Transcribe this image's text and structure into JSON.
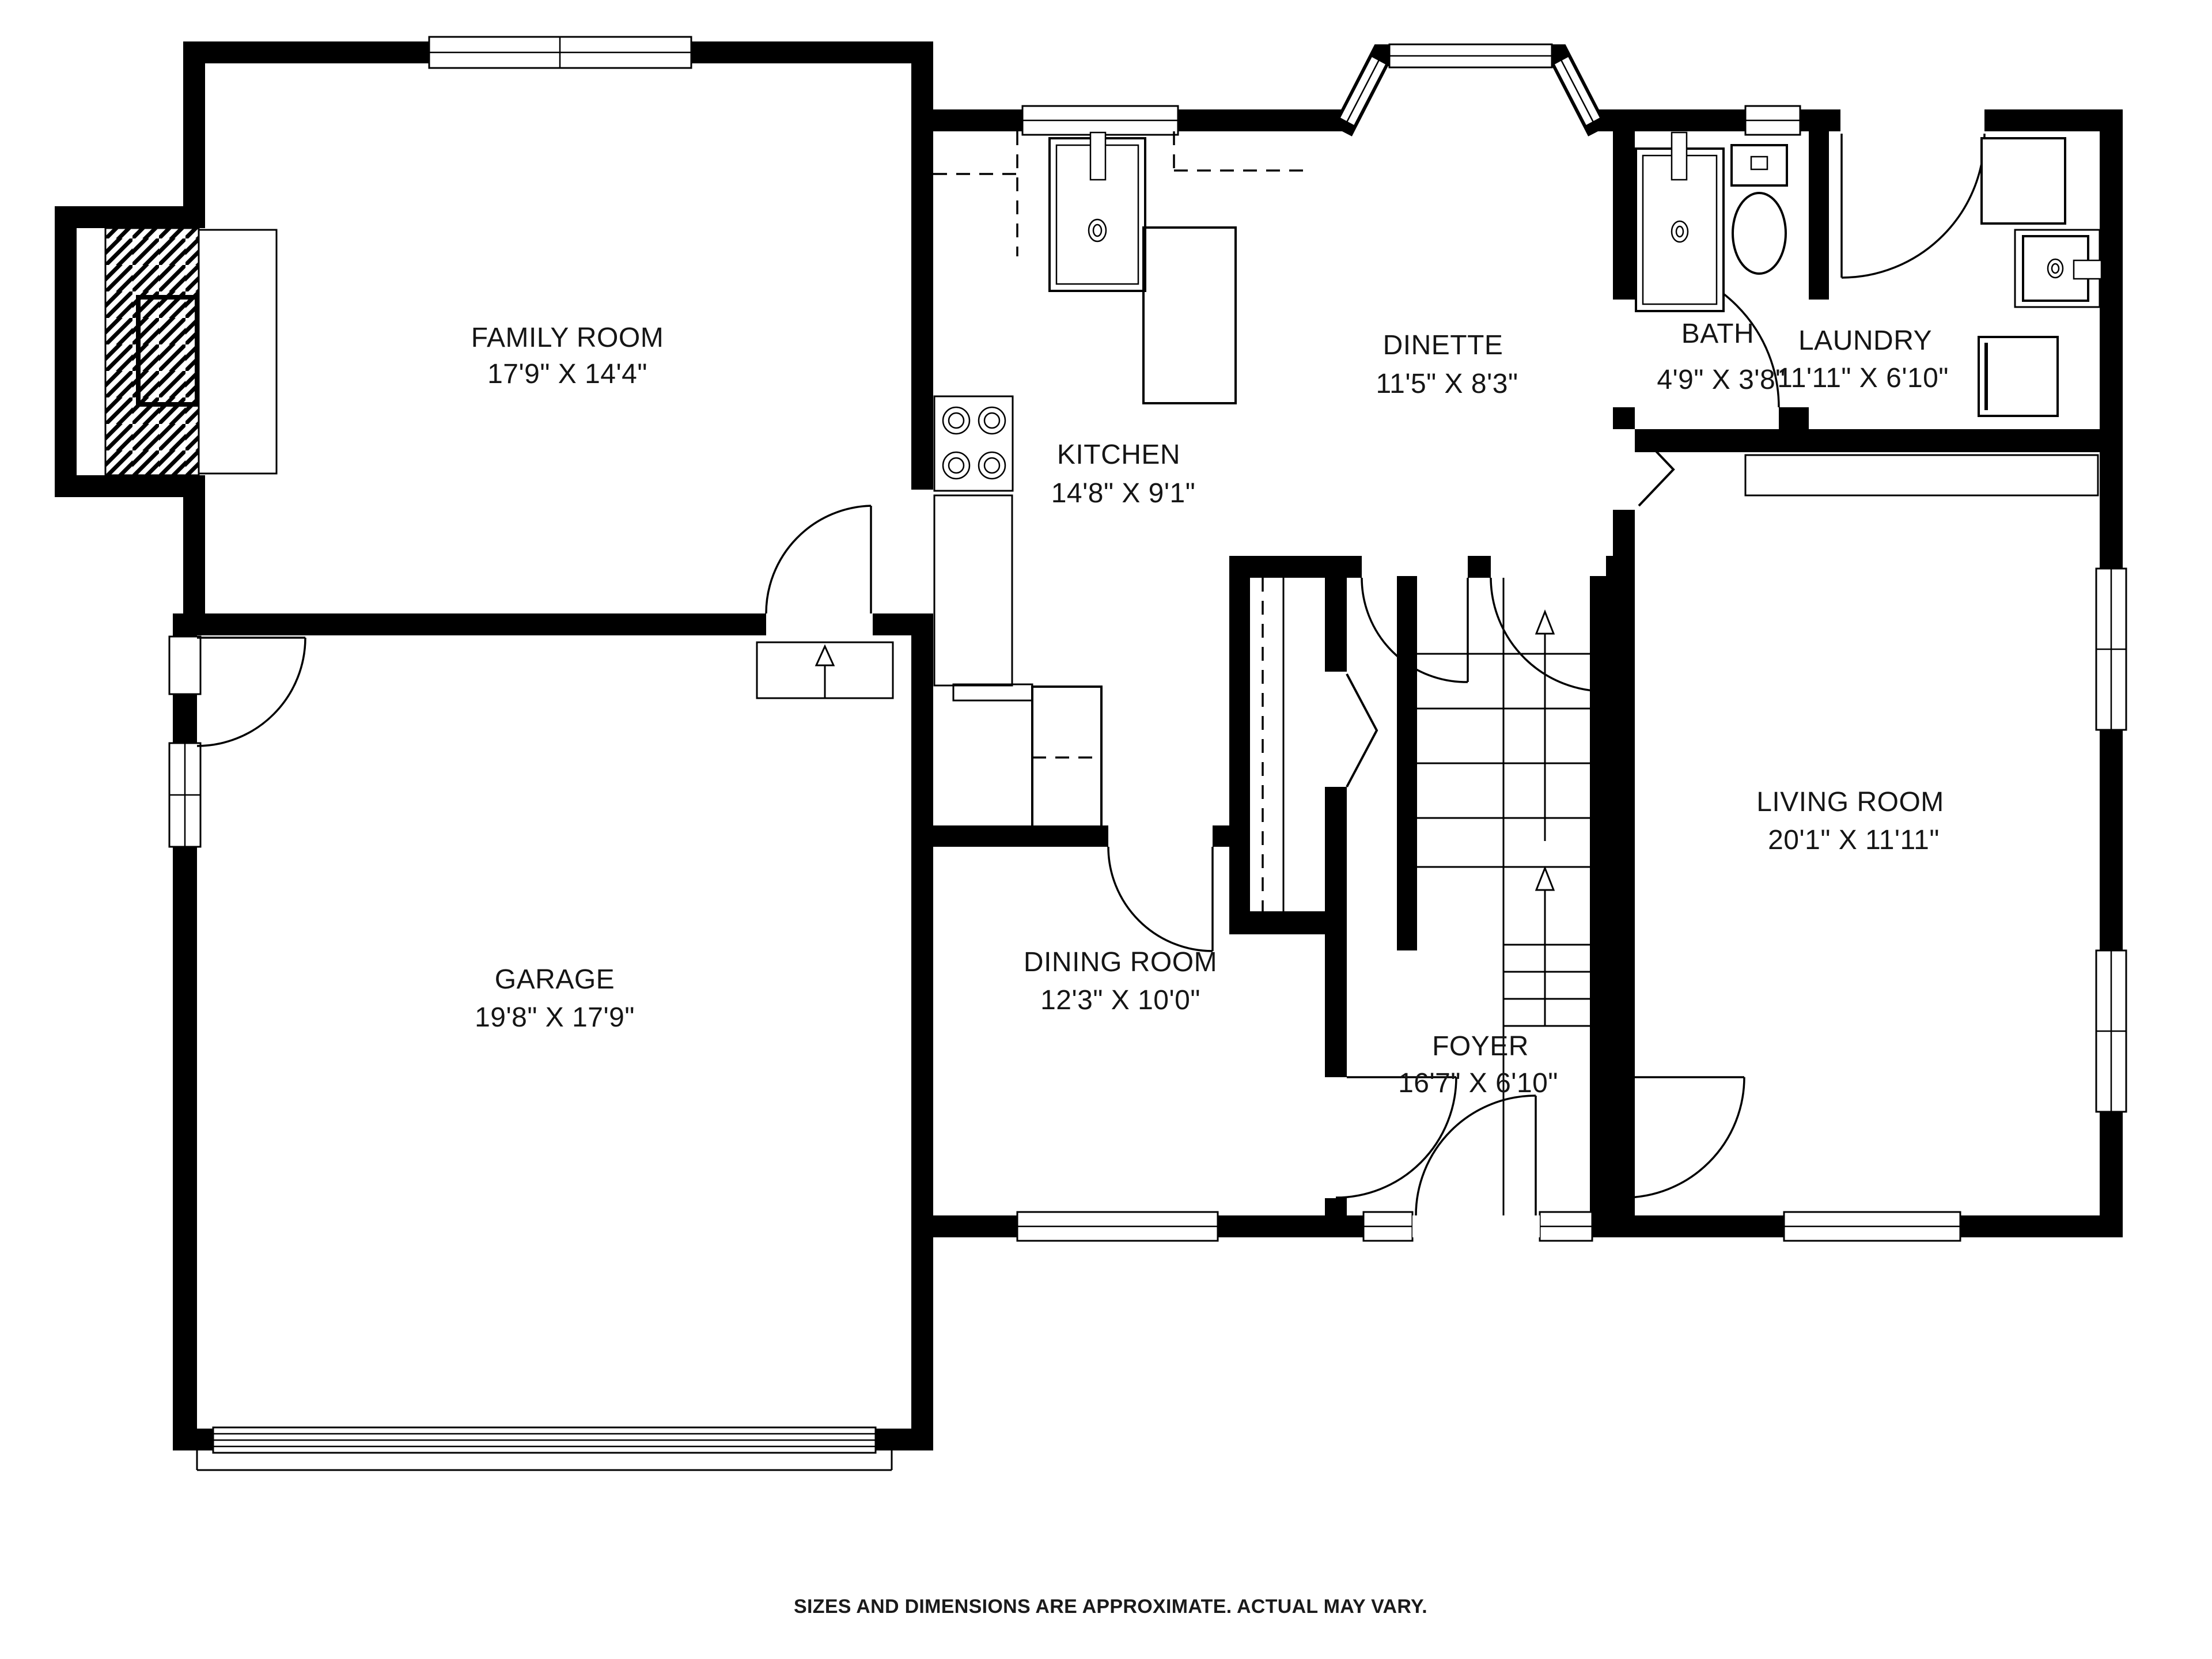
{
  "plan": {
    "title": "First floor plan",
    "rooms": {
      "family_room": {
        "name": "FAMILY ROOM",
        "dims": "17'9\" X 14'4\""
      },
      "kitchen": {
        "name": "KITCHEN",
        "dims": "14'8\" X 9'1\""
      },
      "dinette": {
        "name": "DINETTE",
        "dims": "11'5\" X 8'3\""
      },
      "bath": {
        "name": "BATH",
        "dims": "4'9\" X 3'8\""
      },
      "laundry": {
        "name": "LAUNDRY",
        "dims": "11'11\" X 6'10\""
      },
      "garage": {
        "name": "GARAGE",
        "dims": "19'8\" X 17'9\""
      },
      "dining_room": {
        "name": "DINING ROOM",
        "dims": "12'3\" X 10'0\""
      },
      "foyer": {
        "name": "FOYER",
        "dims": "16'7\" X 6'10\""
      },
      "living_room": {
        "name": "LIVING ROOM",
        "dims": "20'1\" X 11'11\""
      }
    },
    "fixtures": [
      "fireplace",
      "kitchen-sink",
      "cooktop",
      "refrigerator",
      "kitchen-island",
      "bay-window",
      "toilet",
      "vanity-sink",
      "washer",
      "dryer",
      "utility-sink",
      "stairs-up",
      "garage-door",
      "closet-shelf"
    ],
    "footer": "SIZES AND DIMENSIONS ARE APPROXIMATE. ACTUAL MAY VARY.",
    "colors": {
      "wall": "#000000",
      "background": "#ffffff",
      "text": "#151515"
    }
  }
}
